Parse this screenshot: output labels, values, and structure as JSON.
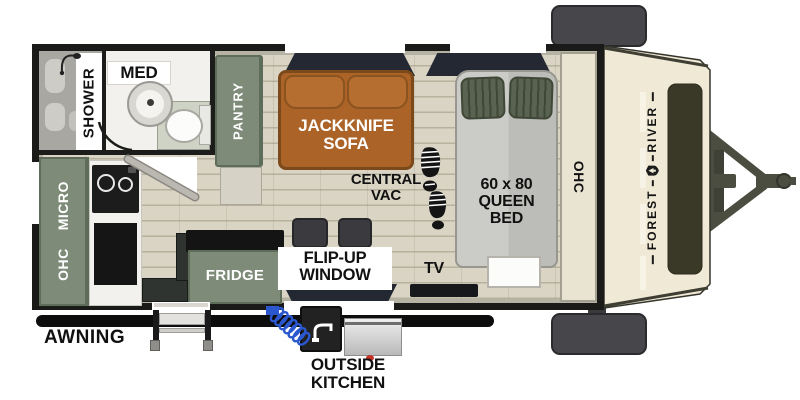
{
  "floorplan": {
    "brand": {
      "first": "FOREST",
      "second": "RIVER",
      "full": "FOREST RIVER"
    },
    "rooms": {
      "shower": "SHOWER",
      "med": "MED",
      "pantry": "PANTRY",
      "sofa_line1": "JACKKNIFE",
      "sofa_line2": "SOFA",
      "vac_line1": "CENTRAL",
      "vac_line2": "VAC",
      "bed_line1": "60 x 80",
      "bed_line2": "QUEEN",
      "bed_line3": "BED",
      "front_ohc": "OHC",
      "cab_ohc": "OHC",
      "cab_micro": "MICRO",
      "fridge": "FRIDGE",
      "flip_line1": "FLIP-UP",
      "flip_line2": "WINDOW",
      "tv": "TV",
      "awning": "AWNING",
      "outside_line1": "OUTSIDE",
      "outside_line2": "KITCHEN"
    },
    "icons": {
      "boot_print": "boot-print",
      "shower_head": "shower-head",
      "faucet": "faucet",
      "crest": "forest-river-crest"
    },
    "colors": {
      "cabinet_green": "#7e8b78",
      "sofa_brown": "#ab6328",
      "floor_tan": "#d9d4c3",
      "cap_cream": "#efe9d6",
      "pillow_green": "#5a6351",
      "wall_black": "#1a1a18",
      "hose_blue": "#2b57cf",
      "knob_red": "#c43326"
    }
  }
}
